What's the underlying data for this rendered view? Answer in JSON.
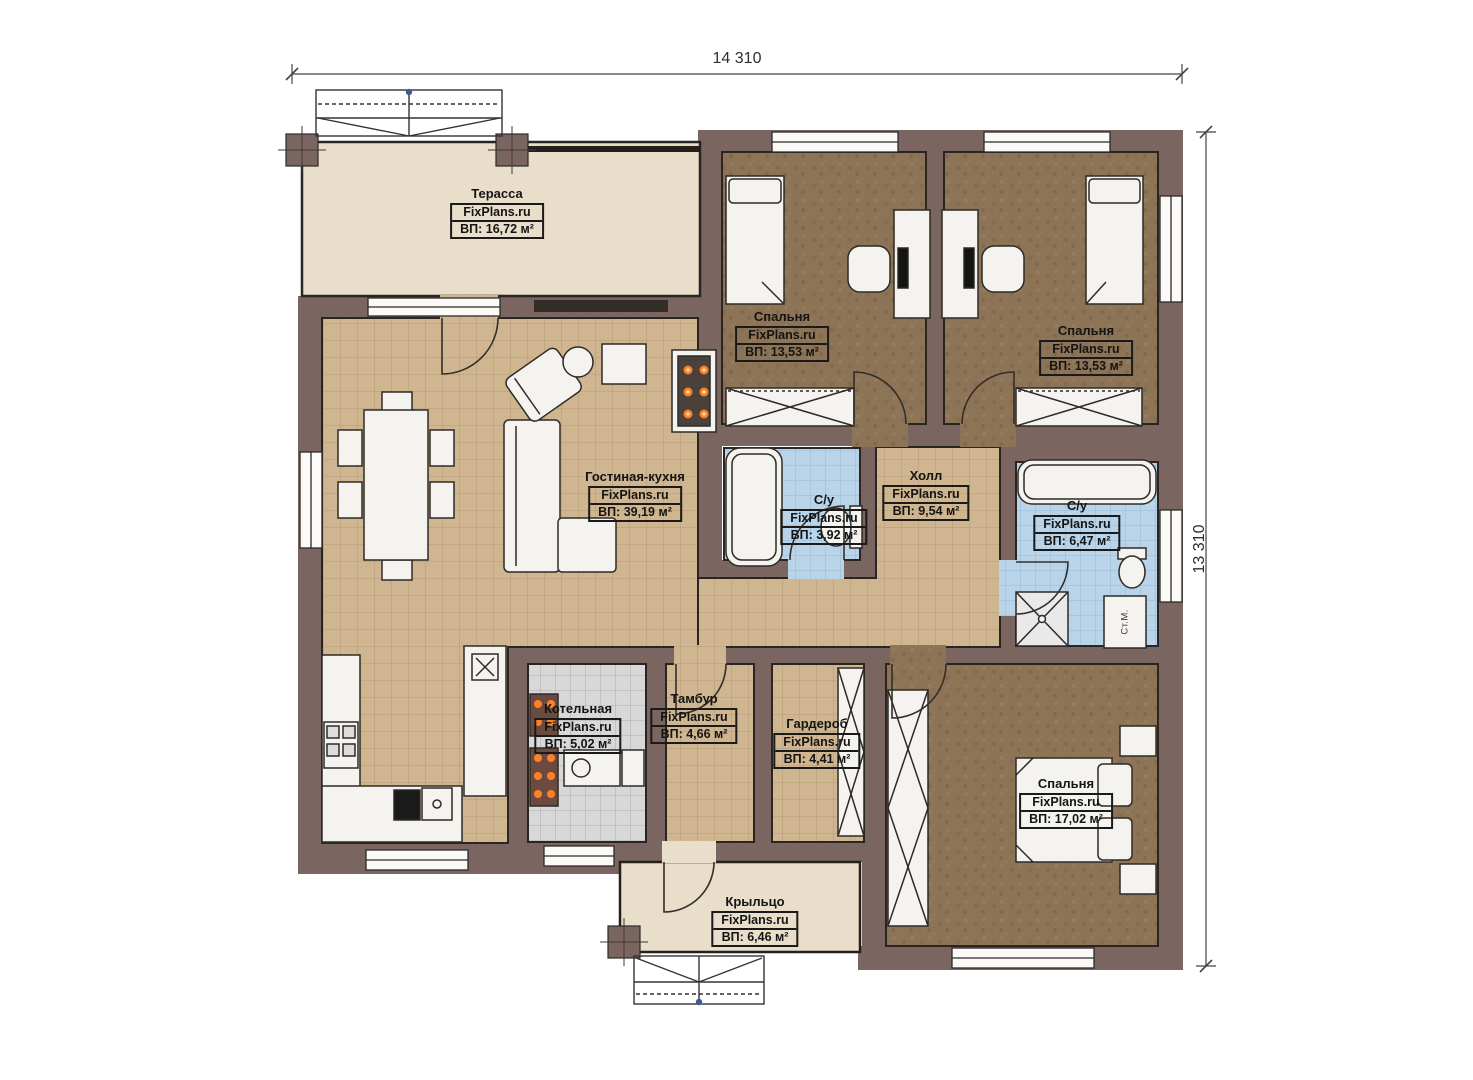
{
  "dimensions": {
    "width": "14 310",
    "height": "13 310"
  },
  "watermark": "FixPlans.ru",
  "rooms": [
    {
      "id": "terrace",
      "name": "Терасса",
      "area": "ВП: 16,72 м²"
    },
    {
      "id": "bedroom-1",
      "name": "Спальня",
      "area": "ВП: 13,53 м²"
    },
    {
      "id": "bedroom-2",
      "name": "Спальня",
      "area": "ВП: 13,53 м²"
    },
    {
      "id": "living-kitchen",
      "name": "Гостиная-кухня",
      "area": "ВП: 39,19 м²"
    },
    {
      "id": "bathroom-1",
      "name": "С/у",
      "area": "ВП: 3,92 м²"
    },
    {
      "id": "hall",
      "name": "Холл",
      "area": "ВП: 9,54 м²"
    },
    {
      "id": "bathroom-2",
      "name": "С/у",
      "area": "ВП: 6,47 м²"
    },
    {
      "id": "boiler-room",
      "name": "Котельная",
      "area": "ВП: 5,02 м²"
    },
    {
      "id": "vestibule",
      "name": "Тамбур",
      "area": "ВП: 4,66 м²"
    },
    {
      "id": "wardrobe-room",
      "name": "Гардероб",
      "area": "ВП: 4,41 м²"
    },
    {
      "id": "bedroom-3",
      "name": "Спальня",
      "area": "ВП: 17,02 м²"
    },
    {
      "id": "porch",
      "name": "Крыльцо",
      "area": "ВП: 6,46 м²"
    }
  ],
  "appliances": {
    "washing_machine": "Ст.М."
  },
  "colors": {
    "wall": "#7b6560",
    "floor_tile_tan": "#cfb690",
    "floor_bedroom_brown": "#8e7456",
    "floor_bath_blue": "#b9d4e9",
    "floor_boiler_gray": "#d8d8d8",
    "floor_terrace_beige": "#e8dec9",
    "fire_orange": "#ff8126",
    "stairs_dot_blue": "#3b5c8f"
  }
}
